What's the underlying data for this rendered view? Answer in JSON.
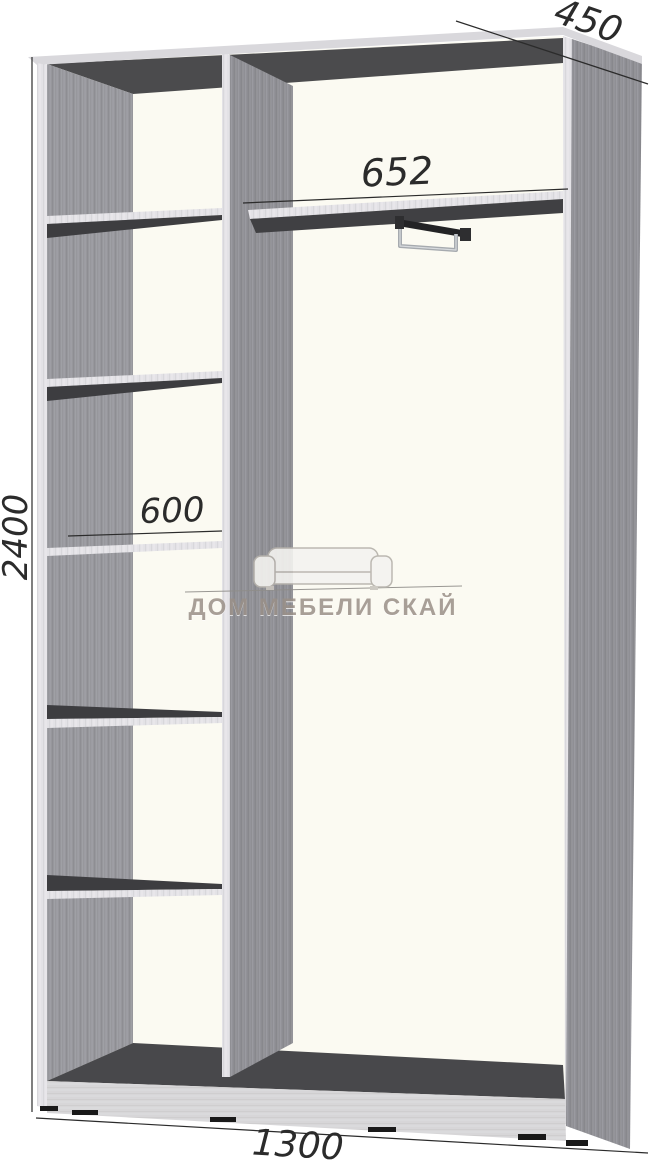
{
  "dimensions": {
    "height": "2400",
    "depth": "450",
    "top_section_width": "652",
    "shelf_width": "600",
    "overall_width": "1300"
  },
  "watermark": {
    "brand": "ДОМ МЕБЕЛИ СКАЙ",
    "icon": "sofa-icon"
  },
  "structure": {
    "left_column_shelves": 5,
    "right_section_feature": "hanger-rail under top shelf"
  },
  "colors": {
    "interior": "#fbfaf2",
    "dark-band": "#4b4b4d",
    "floor": "#48484b",
    "shelf-shadow": "#3d3d40",
    "dim-line": "#2b2b2b",
    "watermark-text": "#9a9088"
  }
}
